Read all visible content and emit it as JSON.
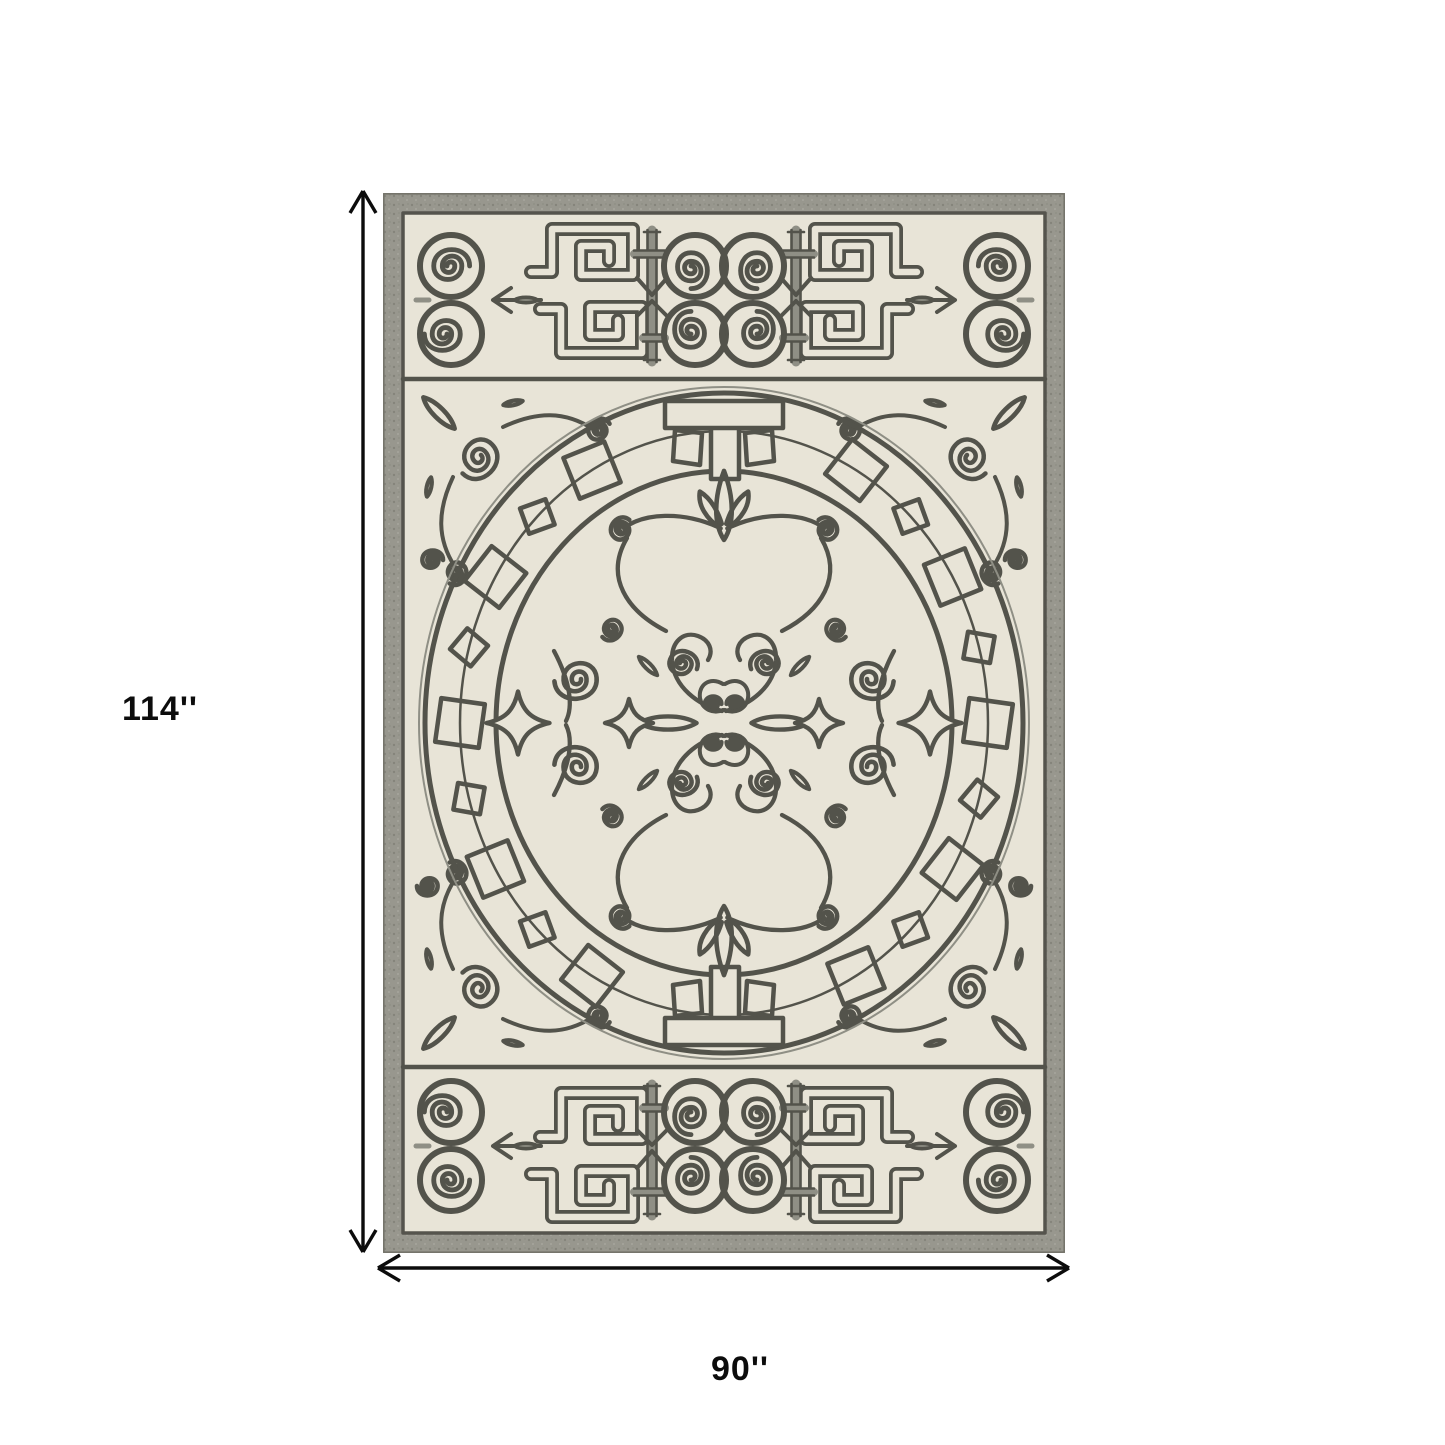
{
  "labels": {
    "height": "114''",
    "width": "90''"
  },
  "colors": {
    "page-bg": "#ffffff",
    "ivory": "#e8e4d7",
    "line": "#53534b",
    "line-soft": "#8f8f85",
    "border-grey": "#98978e",
    "border-dark": "#75746b",
    "dim-ink": "#0c0c0c"
  },
  "rug": {
    "alt": "Ivory and gray ornamental rug with Greek key friezes, scroll spirals and a circular Greek-key center medallion"
  },
  "icons": {
    "vertical_arrow": "double-headed-vertical-arrow",
    "horizontal_arrow": "double-headed-horizontal-arrow"
  }
}
